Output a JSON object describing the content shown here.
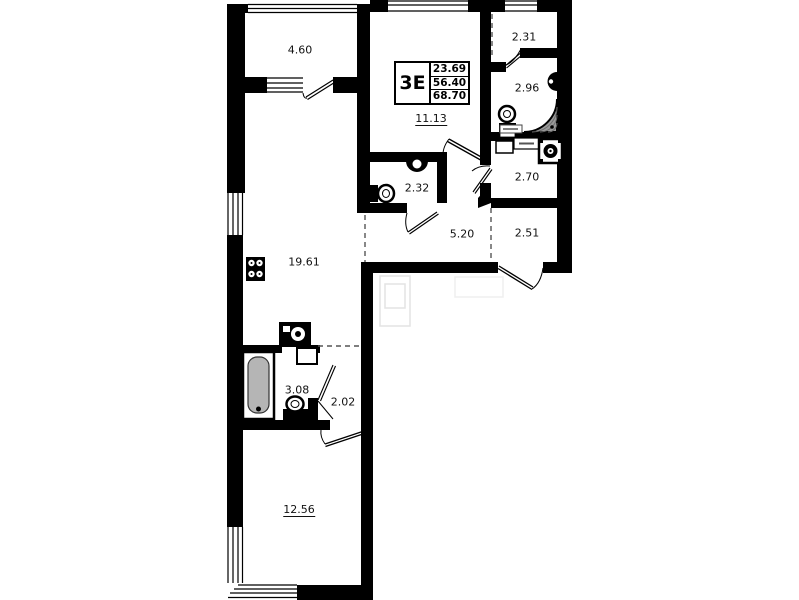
{
  "title_block": {
    "type": "3Е",
    "living_area": "23.69",
    "apartment_area": "56.40",
    "total_area": "68.70"
  },
  "rooms": {
    "balcony": "4.60",
    "hall_top": "2.31",
    "bathroom_top": "2.96",
    "living_room": "11.13",
    "wc": "2.32",
    "hall_right": "2.70",
    "corridor": "5.20",
    "entry": "2.51",
    "kitchen_living": "19.61",
    "bathroom": "3.08",
    "hall_bottom": "2.02",
    "bedroom": "12.56"
  }
}
